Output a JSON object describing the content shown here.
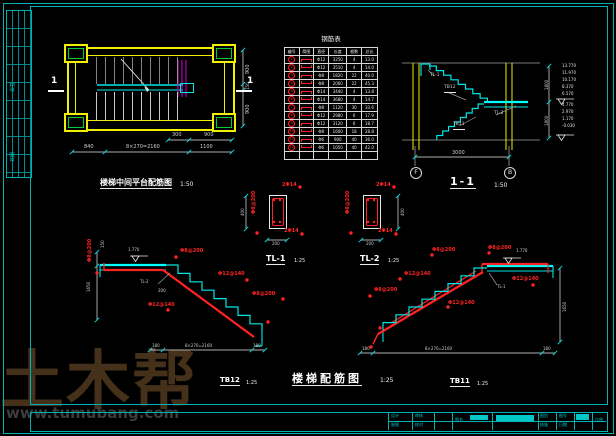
{
  "colors": {
    "cyan": "#00e6e6",
    "yellow": "#f0f000",
    "red": "#ff2222",
    "green": "#00cc33",
    "magenta": "#d800d8",
    "watermark": "#45301a"
  },
  "watermark": {
    "brand": "土木帮",
    "url": "www.tumubang.com"
  },
  "sig": {
    "label1": "会签",
    "label2": "日期"
  },
  "plan": {
    "title": "楼梯中间平台配筋图",
    "scale": "1:50",
    "section_mark": "1",
    "dims": {
      "bottom": [
        "840",
        "8×270=2160",
        "1100"
      ],
      "top": [
        "300",
        "900"
      ],
      "right": [
        "900",
        "150",
        "900"
      ]
    }
  },
  "table": {
    "title": "钢筋表",
    "headers": [
      "编号",
      "简图",
      "直径",
      "长度",
      "根数",
      "总长"
    ],
    "rows": [
      [
        "1",
        "Φ12",
        "3250",
        "4",
        "13.0"
      ],
      [
        "2",
        "Φ12",
        "3510",
        "4",
        "14.0"
      ],
      [
        "3",
        "Φ8",
        "1820",
        "22",
        "40.0"
      ],
      [
        "4",
        "Φ8",
        "2060",
        "22",
        "45.3"
      ],
      [
        "5",
        "Φ14",
        "3440",
        "4",
        "13.8"
      ],
      [
        "6",
        "Φ14",
        "3680",
        "4",
        "14.7"
      ],
      [
        "7",
        "Φ8",
        "1120",
        "30",
        "33.6"
      ],
      [
        "8",
        "Φ12",
        "2980",
        "6",
        "17.9"
      ],
      [
        "9",
        "Φ12",
        "3120",
        "6",
        "18.7"
      ],
      [
        "10",
        "Φ8",
        "1600",
        "18",
        "28.8"
      ],
      [
        "11",
        "Φ6",
        "900",
        "40",
        "36.0"
      ],
      [
        "12",
        "Φ6",
        "1050",
        "40",
        "42.0"
      ]
    ]
  },
  "section": {
    "title": "1-1",
    "scale": "1:50",
    "span_dim": "3000",
    "axis_left": "F",
    "axis_right": "B",
    "labels": {
      "tl_top": "TL-1",
      "flight_upper": "TB12",
      "tl_mid": "TL-2",
      "flight_lower": "TB11"
    },
    "story_dims": [
      "1800",
      "1800"
    ],
    "elevations": {
      "upper": [
        "13.770",
        "11.970",
        "10.170",
        "8.370",
        "6.570"
      ],
      "lower": [
        "4.770",
        "2.970",
        "1.170",
        "-0.030"
      ]
    }
  },
  "details": {
    "scale": "1:25",
    "width_dim": "200",
    "height_dim": "400",
    "tl1": {
      "title": "TL-1"
    },
    "tl2": {
      "title": "TL-2"
    }
  },
  "tags": {
    "tl1": [
      "2Φ14",
      "2Φ14",
      "Φ8@200"
    ],
    "tl2": [
      "2Φ14",
      "2Φ14",
      "Φ8@200"
    ],
    "tb12": [
      "Φ8@200",
      "Φ12@140",
      "Φ8@200",
      "Φ12@140",
      "Φ8@200"
    ],
    "tb11": [
      "Φ8@200",
      "Φ8@200",
      "Φ12@140",
      "Φ12@140",
      "Φ8@200",
      "Φ12@140"
    ]
  },
  "tb12": {
    "title": "TB12",
    "scale": "1:25",
    "beam_label": "TL-2",
    "level": "1.770",
    "vdim": "1650",
    "vdim2": "150",
    "step_dim": "200",
    "dims": [
      "180",
      "8×270=2160",
      "180"
    ]
  },
  "tb11": {
    "title": "TB11",
    "scale": "1:25",
    "beam_label": "TL-1",
    "level": "1.770",
    "vdim": "1650",
    "dims": [
      "180",
      "8×270=2160",
      "180"
    ]
  },
  "main_title": {
    "text": "楼梯配筋图",
    "scale": "1:25"
  },
  "titleblock": {
    "design": "设计",
    "draft": "制图",
    "check": "审核",
    "proof": "校对",
    "name_label": "图名",
    "no_label": "图号",
    "scale_label": "比例",
    "date_label": "日期",
    "type_label": "图别",
    "type_value": "结施"
  }
}
